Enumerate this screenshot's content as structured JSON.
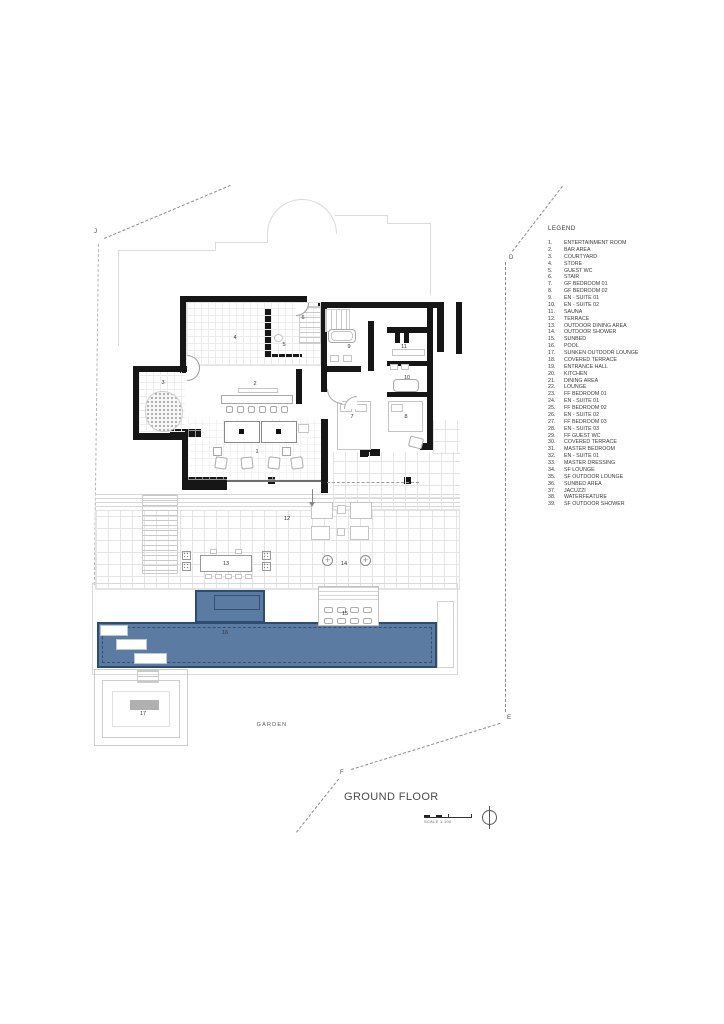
{
  "drawing": {
    "title": "GROUND FLOOR",
    "scale_label": "SCALE 1:100",
    "garden_label": "GARDEN",
    "colors": {
      "pool_fill": "#5b7ba3",
      "pool_border": "#2e4b70",
      "wall": "#161616",
      "boundary_dash": "#8a8a8a"
    },
    "legend": {
      "title": "LEGEND",
      "items": [
        {
          "num": "1.",
          "label": "ENTERTAINMENT ROOM"
        },
        {
          "num": "2.",
          "label": "BAR AREA"
        },
        {
          "num": "3.",
          "label": "COURTYARD"
        },
        {
          "num": "4.",
          "label": "STORE"
        },
        {
          "num": "5.",
          "label": "GUEST WC"
        },
        {
          "num": "6.",
          "label": "STAIR"
        },
        {
          "num": "7.",
          "label": "GF BEDROOM 01"
        },
        {
          "num": "8.",
          "label": "GF BEDROOM 02"
        },
        {
          "num": "9.",
          "label": "EN - SUITE 01"
        },
        {
          "num": "10.",
          "label": "EN - SUITE 02"
        },
        {
          "num": "11.",
          "label": "SAUNA"
        },
        {
          "num": "12.",
          "label": "TERRACE"
        },
        {
          "num": "13.",
          "label": "OUTDOOR DINING AREA"
        },
        {
          "num": "14.",
          "label": "OUTDOOR SHOWER"
        },
        {
          "num": "15.",
          "label": "SUNBED"
        },
        {
          "num": "16.",
          "label": "POOL"
        },
        {
          "num": "17.",
          "label": "SUNKEN OUTDOOR LOUNGE"
        },
        {
          "num": "18.",
          "label": "COVERED TERRACE"
        },
        {
          "num": "19.",
          "label": "ENTRANCE HALL"
        },
        {
          "num": "20.",
          "label": "KITCHEN"
        },
        {
          "num": "21.",
          "label": "DINING AREA"
        },
        {
          "num": "22.",
          "label": "LOUNGE"
        },
        {
          "num": "23.",
          "label": "FF BEDROOM 01"
        },
        {
          "num": "24.",
          "label": "EN - SUITE 01"
        },
        {
          "num": "25.",
          "label": "FF BEDROOM 02"
        },
        {
          "num": "26.",
          "label": "EN - SUITE 02"
        },
        {
          "num": "27.",
          "label": "FF BEDROOM 03"
        },
        {
          "num": "28.",
          "label": "EN - SUITE 03"
        },
        {
          "num": "29.",
          "label": "FF GUEST WC"
        },
        {
          "num": "30.",
          "label": "COVERED TERRACE"
        },
        {
          "num": "31.",
          "label": "MASTER BEDROOM"
        },
        {
          "num": "32.",
          "label": "EN - SUITE 01"
        },
        {
          "num": "33.",
          "label": "MASTER DRESSING"
        },
        {
          "num": "34.",
          "label": "SF LOUNGE"
        },
        {
          "num": "35.",
          "label": "SF OUTDOOR LOUNGE"
        },
        {
          "num": "36.",
          "label": "SUNBED AREA"
        },
        {
          "num": "37.",
          "label": "JACUZZI"
        },
        {
          "num": "38.",
          "label": "WATERFEATURE"
        },
        {
          "num": "39.",
          "label": "SF OUTDOOR SHOWER"
        }
      ]
    },
    "plan": {
      "room_labels": [
        {
          "num": "1",
          "name": "ENTERTAINMENT ROOM"
        },
        {
          "num": "2",
          "name": "BAR AREA"
        },
        {
          "num": "3",
          "name": "COURTYARD"
        },
        {
          "num": "4",
          "name": "STORE"
        },
        {
          "num": "5",
          "name": "GUEST WC"
        },
        {
          "num": "6",
          "name": "STAIR"
        },
        {
          "num": "7",
          "name": "GF BEDROOM 01"
        },
        {
          "num": "8",
          "name": "GF BEDROOM 02"
        },
        {
          "num": "9",
          "name": "EN - SUITE 01"
        },
        {
          "num": "10",
          "name": "EN - SUITE 02"
        },
        {
          "num": "11",
          "name": "SAUNA"
        },
        {
          "num": "12",
          "name": "TERRACE"
        },
        {
          "num": "13",
          "name": "OUTDOOR DINING AREA"
        },
        {
          "num": "14",
          "name": "OUTDOOR SHOWER"
        },
        {
          "num": "15",
          "name": "SUNBED"
        },
        {
          "num": "16",
          "name": "POOL"
        },
        {
          "num": "17",
          "name": "SUNKEN OUTDOOR LOUNGE"
        }
      ],
      "boundary_markers": [
        {
          "id": "J"
        },
        {
          "id": "D"
        },
        {
          "id": "E"
        },
        {
          "id": "F"
        }
      ]
    }
  }
}
